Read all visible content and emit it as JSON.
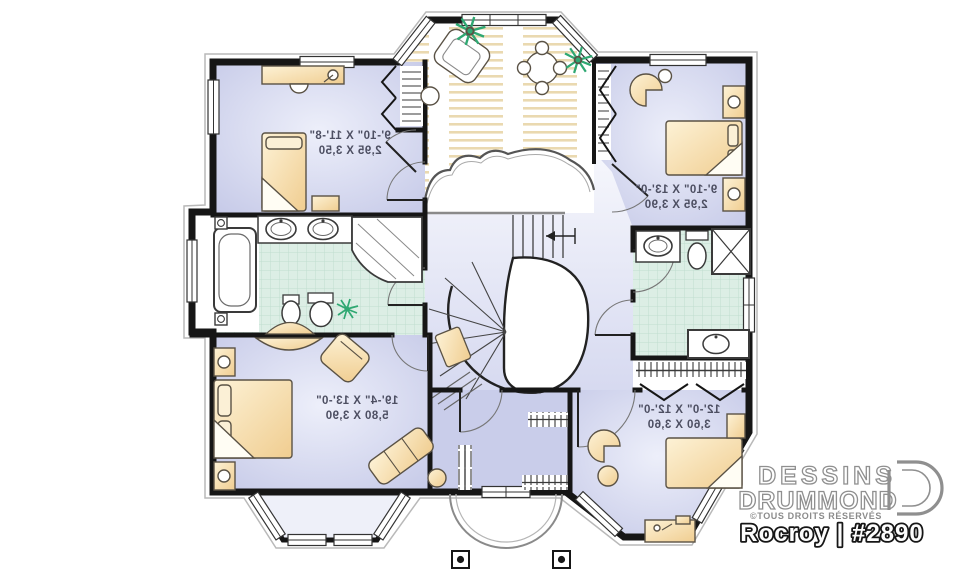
{
  "branding": {
    "name_line1": "DESSINS",
    "name_line2": "DRUMMOND",
    "rights": "©TOUS DROITS RÉSERVÉS",
    "logo_icon": "drummond-d-icon"
  },
  "plan": {
    "title": "Rocroy | #2890",
    "note": "floor plan shown mirrored (reversed reading)"
  },
  "rooms": [
    {
      "id": "bedroom-top-left",
      "imperial": "9'-10\" X 11'-8\"",
      "metric": "2,95 X 3,50"
    },
    {
      "id": "bedroom-top-right",
      "imperial": "9'-10\" X 13'-0\"",
      "metric": "2,95 X 3,90"
    },
    {
      "id": "master-bedroom",
      "imperial": "19'-4\" X 13'-0\"",
      "metric": "5,80 X 3,90"
    },
    {
      "id": "bedroom-bottom-right",
      "imperial": "12'-0\" X 12'-0\"",
      "metric": "3,60 X 3,60"
    }
  ],
  "colors": {
    "wall": "#161616",
    "bedroom_floor": "#c6cae8",
    "hall_floor": "#d3d6ee",
    "tile_floor": "#dceee5",
    "wood_accent": "#ead9b0",
    "furniture": "#f5d79e",
    "plant": "#2fa872",
    "label_text": "#4d4f62",
    "logo_gray": "#8f8f8f"
  }
}
